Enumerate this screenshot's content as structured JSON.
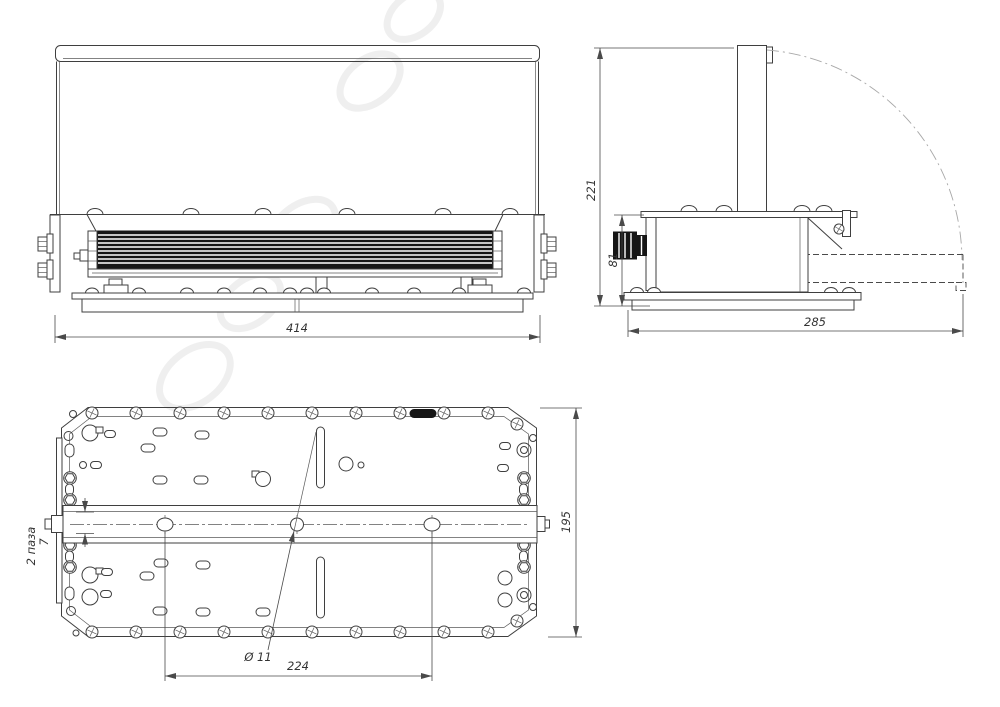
{
  "drawing": {
    "dimensions": {
      "front_width": "414",
      "side_total_height": "221",
      "side_body_height": "81",
      "side_total_depth": "285",
      "plan_depth": "195",
      "plan_hole_spacing": "224",
      "plan_hole_diameter": "Ø 11",
      "plan_slot_width": "7",
      "plan_slot_note": "2 паза"
    },
    "colors": {
      "line": "#3f3f3f",
      "dimension": "#4a4a4a",
      "dark_fill": "#161616",
      "phantom_line": "#a8a8a8",
      "background": "#ffffff"
    }
  }
}
